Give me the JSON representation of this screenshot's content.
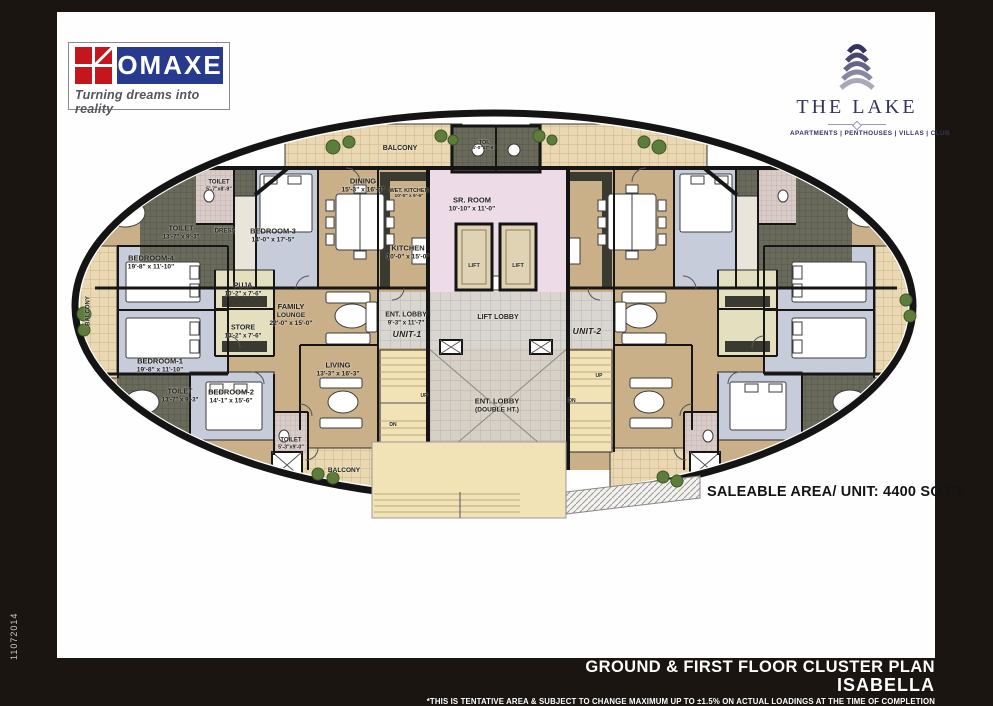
{
  "header": {
    "omaxe": {
      "name": "OMAXE",
      "tagline": "Turning dreams into reality"
    },
    "the_lake": {
      "name": "THE LAKE",
      "categories": "APARTMENTS | PENTHOUSES | VILLAS | CLUB"
    }
  },
  "plan": {
    "saleable_area": "SALEABLE AREA/ UNIT: 4400 SQ.FT.",
    "labels": [
      {
        "lines": [
          "BALCONY"
        ],
        "x": 400,
        "y": 149,
        "fs": 7
      },
      {
        "lines": [
          "TOI.",
          "4'-0\"x7'-6\""
        ],
        "x": 484,
        "y": 146,
        "fs": 5.5
      },
      {
        "lines": [
          "DINING",
          "15'-3\" x 16'-3\""
        ],
        "x": 363,
        "y": 186,
        "fs": 7.5
      },
      {
        "lines": [
          "WET. KITCHEN",
          "10'-0\" x 9'-6\""
        ],
        "x": 409,
        "y": 194,
        "fs": 5.5
      },
      {
        "lines": [
          "SR. ROOM",
          "10'-10\" x 11'-0\""
        ],
        "x": 472,
        "y": 205,
        "fs": 7.5
      },
      {
        "lines": [
          "TOILET",
          "5'-7\"x8'-9\""
        ],
        "x": 219,
        "y": 186,
        "fs": 6
      },
      {
        "lines": [
          "TOILET",
          "13'-7\" x 9'-3\""
        ],
        "x": 181,
        "y": 233,
        "fs": 7
      },
      {
        "lines": [
          "DRESS"
        ],
        "x": 225,
        "y": 232,
        "fs": 6
      },
      {
        "lines": [
          "BEDROOM-3",
          "14'-0\" x 17'-5\""
        ],
        "x": 273,
        "y": 236,
        "fs": 7.5
      },
      {
        "lines": [
          "KITCHEN",
          "10'-0\" x 15'-0\""
        ],
        "x": 408,
        "y": 253,
        "fs": 7.5
      },
      {
        "lines": [
          "BEDROOM-4",
          "19'-8\" x 11'-10\""
        ],
        "x": 151,
        "y": 263,
        "fs": 7.5
      },
      {
        "lines": [
          "LIFT"
        ],
        "x": 474,
        "y": 266,
        "fs": 5.5
      },
      {
        "lines": [
          "LIFT"
        ],
        "x": 518,
        "y": 266,
        "fs": 5.5
      },
      {
        "lines": [
          "PUJA",
          "10'-2\" x 7'-6\""
        ],
        "x": 243,
        "y": 290,
        "fs": 7
      },
      {
        "lines": [
          "FAMILY",
          "LOUNGE",
          "22'-0\" x 15'-0\""
        ],
        "x": 291,
        "y": 315,
        "fs": 7.5
      },
      {
        "lines": [
          "ENT. LOBBY",
          "9'-3\" x 11'-7\""
        ],
        "x": 406,
        "y": 319,
        "fs": 7
      },
      {
        "lines": [
          "LIFT LOBBY"
        ],
        "x": 498,
        "y": 318,
        "fs": 7
      },
      {
        "lines": [
          "STORE",
          "10'-2\" x 7'-6\""
        ],
        "x": 243,
        "y": 332,
        "fs": 7
      },
      {
        "lines": [
          "UNIT-1"
        ],
        "x": 407,
        "y": 334,
        "fs": 8.5,
        "style": "unit"
      },
      {
        "lines": [
          "UNIT-2"
        ],
        "x": 587,
        "y": 331,
        "fs": 8.5,
        "style": "unit"
      },
      {
        "lines": [
          "BEDROOM-1",
          "19'-8\" x 11'-10\""
        ],
        "x": 160,
        "y": 366,
        "fs": 7.5
      },
      {
        "lines": [
          "LIVING",
          "13'-3\" x 16'-3\""
        ],
        "x": 338,
        "y": 370,
        "fs": 7.5
      },
      {
        "lines": [
          "UP"
        ],
        "x": 424,
        "y": 397,
        "fs": 5
      },
      {
        "lines": [
          "UP"
        ],
        "x": 599,
        "y": 377,
        "fs": 5
      },
      {
        "lines": [
          "TOILET",
          "13'-7\" x 9'-3\""
        ],
        "x": 180,
        "y": 396,
        "fs": 7
      },
      {
        "lines": [
          "BEDROOM-2",
          "14'-1\" x 15'-6\""
        ],
        "x": 231,
        "y": 397,
        "fs": 7.5
      },
      {
        "lines": [
          "ENT. LOBBY",
          "(DOUBLE HT.)"
        ],
        "x": 497,
        "y": 406,
        "fs": 7.5
      },
      {
        "lines": [
          "DN"
        ],
        "x": 393,
        "y": 426,
        "fs": 5
      },
      {
        "lines": [
          "DN"
        ],
        "x": 572,
        "y": 402,
        "fs": 5
      },
      {
        "lines": [
          "TOILET",
          "5'-3\"x9'-0\""
        ],
        "x": 291,
        "y": 444,
        "fs": 6
      },
      {
        "lines": [
          "BALCONY"
        ],
        "x": 344,
        "y": 471,
        "fs": 6.5
      },
      {
        "lines": [
          "BALCONY"
        ],
        "x": 89,
        "y": 311,
        "fs": 6,
        "rot": -90
      }
    ]
  },
  "footer": {
    "title": "GROUND & FIRST FLOOR  CLUSTER PLAN",
    "subtitle": "ISABELLA",
    "disclaimer": "*THIS IS TENTATIVE AREA & SUBJECT TO CHANGE MAXIMUM UP TO ±1.5% ON ACTUAL  LOADINGS AT THE TIME OF COMPLETION"
  },
  "side_code": "11072014",
  "colors": {
    "omaxe_red": "#c4161c",
    "omaxe_blue": "#283a8e",
    "lake_navy": "#34325f",
    "plan_beige": "#c9b089",
    "plan_blue": "#c7ccdb",
    "plan_pink": "#eddce8"
  }
}
